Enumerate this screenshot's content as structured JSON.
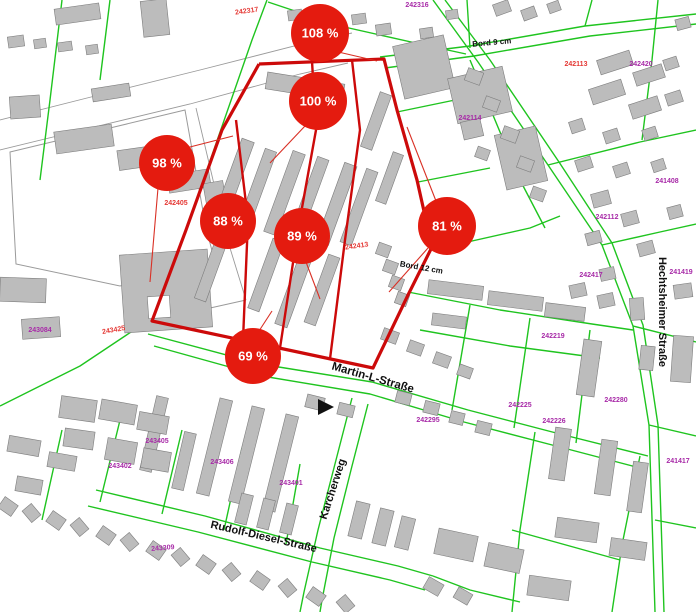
{
  "map": {
    "width": 696,
    "height": 612,
    "colors": {
      "background": "#ffffff",
      "parcel_line": "#1fc41f",
      "building_fill": "#bcbcbc",
      "building_stroke": "#7d7d7d",
      "road_outline": "#9a9a9a",
      "boundary_red": "#cc0a0a",
      "connector_red": "#d93025",
      "badge_red": "#e41b0f",
      "badge_text": "#ffffff",
      "label_magenta": "#a82ba8",
      "label_red": "#e53935",
      "street_text": "#101010"
    },
    "badges": [
      {
        "label": "108 %",
        "cx": 320,
        "cy": 33,
        "r": 29
      },
      {
        "label": "100 %",
        "cx": 318,
        "cy": 101,
        "r": 29
      },
      {
        "label": "98 %",
        "cx": 167,
        "cy": 163,
        "r": 28
      },
      {
        "label": "88 %",
        "cx": 228,
        "cy": 221,
        "r": 28
      },
      {
        "label": "89 %",
        "cx": 302,
        "cy": 236,
        "r": 28
      },
      {
        "label": "81 %",
        "cx": 447,
        "cy": 226,
        "r": 29
      },
      {
        "label": "69 %",
        "cx": 253,
        "cy": 356,
        "r": 28
      }
    ],
    "street_labels": [
      {
        "text": "Martin-L-Straße",
        "x": 372,
        "y": 381,
        "rot": 16,
        "size": 11.5
      },
      {
        "text": "Rudolf-Diesel-Straße",
        "x": 263,
        "y": 540,
        "rot": 13,
        "size": 11
      },
      {
        "text": "Karcherweg",
        "x": 336,
        "y": 490,
        "rot": -72,
        "size": 11
      },
      {
        "text": "Hechtsheimer Straße",
        "x": 659,
        "y": 312,
        "rot": 90,
        "size": 11
      },
      {
        "text": "Bord 9 cm",
        "x": 492,
        "y": 45,
        "rot": -5,
        "size": 8
      },
      {
        "text": "Bord 12 cm",
        "x": 421,
        "y": 270,
        "rot": 10,
        "size": 8
      }
    ],
    "parcel_labels": [
      {
        "text": "242317",
        "x": 247,
        "y": 13,
        "rot": -8,
        "c": "r"
      },
      {
        "text": "242316",
        "x": 417,
        "y": 7,
        "rot": 0,
        "c": "m"
      },
      {
        "text": "242113",
        "x": 576,
        "y": 66,
        "rot": 0,
        "c": "r"
      },
      {
        "text": "242420",
        "x": 641,
        "y": 66,
        "rot": 0,
        "c": "m"
      },
      {
        "text": "242114",
        "x": 470,
        "y": 120,
        "rot": 0,
        "c": "m"
      },
      {
        "text": "241408",
        "x": 667,
        "y": 183,
        "rot": 0,
        "c": "m"
      },
      {
        "text": "242112",
        "x": 607,
        "y": 219,
        "rot": 0,
        "c": "m"
      },
      {
        "text": "242405",
        "x": 176,
        "y": 205,
        "rot": 0,
        "c": "r"
      },
      {
        "text": "242417",
        "x": 591,
        "y": 277,
        "rot": 0,
        "c": "m"
      },
      {
        "text": "241419",
        "x": 681,
        "y": 274,
        "rot": 0,
        "c": "m"
      },
      {
        "text": "242413",
        "x": 357,
        "y": 248,
        "rot": -8,
        "c": "r"
      },
      {
        "text": "243084",
        "x": 40,
        "y": 332,
        "rot": 0,
        "c": "m"
      },
      {
        "text": "243425",
        "x": 114,
        "y": 332,
        "rot": -10,
        "c": "r"
      },
      {
        "text": "242219",
        "x": 553,
        "y": 338,
        "rot": 0,
        "c": "m"
      },
      {
        "text": "242225",
        "x": 520,
        "y": 407,
        "rot": 0,
        "c": "m"
      },
      {
        "text": "242226",
        "x": 554,
        "y": 423,
        "rot": 0,
        "c": "m"
      },
      {
        "text": "242280",
        "x": 616,
        "y": 402,
        "rot": 0,
        "c": "m"
      },
      {
        "text": "242295",
        "x": 428,
        "y": 422,
        "rot": 0,
        "c": "m"
      },
      {
        "text": "241417",
        "x": 678,
        "y": 463,
        "rot": 0,
        "c": "m"
      },
      {
        "text": "243405",
        "x": 157,
        "y": 443,
        "rot": 0,
        "c": "m"
      },
      {
        "text": "243402",
        "x": 120,
        "y": 468,
        "rot": 0,
        "c": "m"
      },
      {
        "text": "243406",
        "x": 222,
        "y": 464,
        "rot": 0,
        "c": "m"
      },
      {
        "text": "243401",
        "x": 291,
        "y": 485,
        "rot": 0,
        "c": "m"
      },
      {
        "text": "243309",
        "x": 163,
        "y": 550,
        "rot": -5,
        "c": "m"
      }
    ],
    "boundary": "259,64 384,59 397,110 417,180 432,247 408,295 373,368 152,321 186,230 222,130 259,64",
    "inner_red_lines": [
      "312,61 316,130 298,230 280,348",
      "352,60 360,130 345,240 330,359",
      "236,120 248,220 243,340"
    ],
    "connectors": [
      [
        334,
        51,
        377,
        61
      ],
      [
        305,
        126,
        270,
        163
      ],
      [
        186,
        148,
        233,
        136
      ],
      [
        158,
        188,
        150,
        282
      ],
      [
        306,
        262,
        320,
        299
      ],
      [
        436,
        201,
        407,
        127
      ],
      [
        428,
        248,
        389,
        292
      ],
      [
        259,
        331,
        272,
        311
      ]
    ],
    "green_lines": [
      "267,0 252,40 186,230 152,318",
      "152,318 80,366 0,406",
      "148,334 260,364 372,382 468,410 560,434 648,456",
      "154,346 262,376 370,394 464,422 556,446 640,468",
      "268,2 340,26 420,44 466,54",
      "380,57 470,46 585,26 696,14",
      "385,68 474,56 590,36 696,24",
      "467,0 470,48",
      "433,0 478,62 548,165 602,245 633,326 649,425 655,612",
      "445,0 490,60 559,162 612,243 643,325 658,425 664,612",
      "548,165 640,142 696,130",
      "602,245 660,232 696,224",
      "633,326 696,342",
      "649,425 696,436",
      "470,60 520,180 545,228",
      "432,250 530,228 560,216",
      "397,112 455,100",
      "418,182 490,168",
      "408,292 500,310 592,324 633,330",
      "420,330 510,346 600,358",
      "470,305 452,410",
      "530,318 514,428",
      "590,330 576,443",
      "352,398 336,460 318,530 304,592 300,612",
      "368,404 352,466 334,538 322,600 320,612",
      "96,490 205,516 320,548 398,566 433,576",
      "88,506 198,532 312,562 390,580 425,590",
      "62,430 42,520",
      "122,412 100,502",
      "182,430 162,514",
      "242,448 224,530",
      "300,464 286,544",
      "62,0 50,100 40,180",
      "110,0 100,80",
      "640,456 622,545 612,612",
      "535,432 520,530 512,612",
      "512,530 620,560",
      "433,576 470,590 520,602",
      "585,26 592,0",
      "642,140 652,60 658,0",
      "655,520 696,528"
    ],
    "road_lines": [
      "0,120 95,96 200,70 310,42 352,33",
      "0,150 90,128 190,104 300,74 348,63",
      "196,108 226,235 246,300",
      "246,300 152,321"
    ],
    "paved_outlines": [
      "10,152 185,110 206,228 215,262 120,286 16,264"
    ],
    "flag_marker": "318,399 334,407 318,415",
    "buildings": [
      [
        55,
        6,
        45,
        16,
        -8
      ],
      [
        142,
        0,
        26,
        36,
        -6
      ],
      [
        8,
        36,
        16,
        11,
        -8
      ],
      [
        34,
        39,
        12,
        9,
        -8
      ],
      [
        58,
        42,
        14,
        9,
        -8
      ],
      [
        86,
        45,
        12,
        9,
        -8
      ],
      [
        92,
        86,
        38,
        13,
        -9
      ],
      [
        10,
        96,
        30,
        22,
        -4
      ],
      [
        55,
        128,
        58,
        22,
        -8
      ],
      [
        118,
        147,
        52,
        20,
        -8
      ],
      [
        168,
        172,
        42,
        18,
        -9
      ],
      [
        205,
        182,
        20,
        26,
        -10
      ],
      [
        232,
        208,
        16,
        13,
        -10
      ],
      [
        122,
        252,
        88,
        78,
        -4
      ],
      [
        22,
        318,
        38,
        20,
        -4
      ],
      [
        0,
        278,
        46,
        24,
        2
      ],
      [
        398,
        40,
        52,
        54,
        -13
      ],
      [
        452,
        72,
        56,
        46,
        -13
      ],
      [
        500,
        130,
        42,
        56,
        -13
      ],
      [
        462,
        120,
        20,
        18,
        -13
      ],
      [
        288,
        10,
        14,
        10,
        -8
      ],
      [
        352,
        14,
        14,
        10,
        -8
      ],
      [
        376,
        24,
        15,
        11,
        -8
      ],
      [
        420,
        28,
        13,
        10,
        -8
      ],
      [
        446,
        10,
        12,
        9,
        -8
      ],
      [
        494,
        2,
        16,
        12,
        -20
      ],
      [
        522,
        8,
        14,
        11,
        -20
      ],
      [
        548,
        2,
        12,
        10,
        -20
      ],
      [
        676,
        18,
        14,
        11,
        -15
      ],
      [
        598,
        55,
        34,
        15,
        -18
      ],
      [
        634,
        68,
        30,
        14,
        -18
      ],
      [
        664,
        58,
        14,
        11,
        -18
      ],
      [
        590,
        84,
        34,
        16,
        -18
      ],
      [
        630,
        100,
        30,
        15,
        -18
      ],
      [
        666,
        92,
        16,
        12,
        -18
      ],
      [
        570,
        120,
        14,
        12,
        -18
      ],
      [
        604,
        130,
        15,
        12,
        -18
      ],
      [
        643,
        128,
        14,
        11,
        -18
      ],
      [
        576,
        158,
        16,
        12,
        -18
      ],
      [
        614,
        164,
        15,
        12,
        -18
      ],
      [
        652,
        160,
        13,
        11,
        -18
      ],
      [
        266,
        78,
        78,
        17,
        9
      ],
      [
        228,
        138,
        13,
        80,
        20
      ],
      [
        252,
        148,
        12,
        76,
        20
      ],
      [
        278,
        150,
        13,
        86,
        20
      ],
      [
        304,
        156,
        12,
        78,
        20
      ],
      [
        330,
        162,
        13,
        84,
        20
      ],
      [
        353,
        168,
        12,
        78,
        20
      ],
      [
        206,
        232,
        12,
        70,
        20
      ],
      [
        260,
        238,
        12,
        74,
        20
      ],
      [
        288,
        248,
        13,
        80,
        20
      ],
      [
        316,
        254,
        12,
        72,
        20
      ],
      [
        370,
        92,
        12,
        58,
        20
      ],
      [
        384,
        152,
        11,
        52,
        20
      ],
      [
        377,
        244,
        13,
        12,
        20
      ],
      [
        384,
        261,
        13,
        12,
        20
      ],
      [
        390,
        277,
        13,
        12,
        20
      ],
      [
        396,
        293,
        12,
        12,
        20
      ],
      [
        466,
        70,
        16,
        13,
        20
      ],
      [
        484,
        98,
        15,
        12,
        20
      ],
      [
        502,
        128,
        16,
        13,
        20
      ],
      [
        518,
        158,
        15,
        12,
        20
      ],
      [
        531,
        188,
        14,
        12,
        20
      ],
      [
        476,
        148,
        13,
        11,
        20
      ],
      [
        592,
        192,
        18,
        14,
        -15
      ],
      [
        622,
        212,
        16,
        13,
        -15
      ],
      [
        586,
        232,
        15,
        12,
        -15
      ],
      [
        638,
        242,
        16,
        13,
        -15
      ],
      [
        668,
        206,
        14,
        12,
        -15
      ],
      [
        600,
        268,
        15,
        12,
        -12
      ],
      [
        570,
        284,
        16,
        13,
        -12
      ],
      [
        598,
        294,
        16,
        13,
        -12
      ],
      [
        674,
        284,
        18,
        14,
        -8
      ],
      [
        630,
        298,
        14,
        22,
        -4
      ],
      [
        428,
        283,
        55,
        14,
        7
      ],
      [
        488,
        294,
        55,
        14,
        7
      ],
      [
        432,
        315,
        34,
        12,
        7
      ],
      [
        545,
        305,
        40,
        14,
        7
      ],
      [
        382,
        330,
        16,
        12,
        20
      ],
      [
        408,
        342,
        15,
        12,
        20
      ],
      [
        434,
        354,
        16,
        12,
        20
      ],
      [
        458,
        366,
        14,
        11,
        20
      ],
      [
        306,
        396,
        18,
        13,
        14
      ],
      [
        338,
        404,
        16,
        12,
        14
      ],
      [
        396,
        392,
        15,
        12,
        14
      ],
      [
        424,
        402,
        15,
        12,
        14
      ],
      [
        450,
        412,
        14,
        12,
        14
      ],
      [
        476,
        422,
        15,
        12,
        14
      ],
      [
        208,
        398,
        13,
        98,
        14
      ],
      [
        240,
        406,
        13,
        98,
        14
      ],
      [
        274,
        414,
        13,
        98,
        14
      ],
      [
        148,
        396,
        12,
        76,
        13
      ],
      [
        178,
        432,
        12,
        58,
        13
      ],
      [
        100,
        402,
        36,
        20,
        10
      ],
      [
        138,
        414,
        30,
        18,
        10
      ],
      [
        106,
        440,
        30,
        22,
        10
      ],
      [
        142,
        450,
        28,
        20,
        10
      ],
      [
        60,
        398,
        36,
        22,
        8
      ],
      [
        64,
        430,
        30,
        18,
        8
      ],
      [
        238,
        494,
        12,
        30,
        14
      ],
      [
        260,
        499,
        12,
        30,
        14
      ],
      [
        283,
        504,
        12,
        30,
        14
      ],
      [
        352,
        502,
        14,
        36,
        14
      ],
      [
        376,
        509,
        14,
        36,
        14
      ],
      [
        398,
        517,
        14,
        32,
        14
      ],
      [
        436,
        532,
        40,
        26,
        12
      ],
      [
        486,
        546,
        36,
        24,
        12
      ],
      [
        0,
        500,
        16,
        13,
        35
      ],
      [
        24,
        507,
        15,
        12,
        50
      ],
      [
        48,
        514,
        16,
        13,
        35
      ],
      [
        72,
        521,
        15,
        12,
        50
      ],
      [
        98,
        529,
        16,
        13,
        35
      ],
      [
        122,
        536,
        15,
        12,
        50
      ],
      [
        148,
        544,
        16,
        13,
        35
      ],
      [
        173,
        551,
        15,
        12,
        50
      ],
      [
        198,
        558,
        16,
        13,
        35
      ],
      [
        224,
        566,
        15,
        12,
        50
      ],
      [
        252,
        574,
        16,
        13,
        35
      ],
      [
        280,
        582,
        15,
        12,
        50
      ],
      [
        308,
        590,
        16,
        13,
        35
      ],
      [
        338,
        598,
        15,
        12,
        50
      ],
      [
        425,
        580,
        17,
        13,
        30
      ],
      [
        455,
        590,
        16,
        12,
        30
      ],
      [
        580,
        340,
        18,
        56,
        8
      ],
      [
        552,
        428,
        16,
        52,
        8
      ],
      [
        598,
        440,
        16,
        55,
        8
      ],
      [
        630,
        462,
        15,
        50,
        8
      ],
      [
        556,
        520,
        42,
        20,
        8
      ],
      [
        610,
        540,
        36,
        18,
        8
      ],
      [
        528,
        578,
        42,
        20,
        8
      ],
      [
        672,
        336,
        20,
        46,
        4
      ],
      [
        640,
        346,
        14,
        24,
        6
      ],
      [
        8,
        438,
        32,
        16,
        10
      ],
      [
        48,
        454,
        28,
        15,
        10
      ],
      [
        16,
        478,
        26,
        15,
        10
      ]
    ],
    "courtyards": [
      [
        148,
        296,
        22,
        22,
        -4
      ]
    ]
  }
}
